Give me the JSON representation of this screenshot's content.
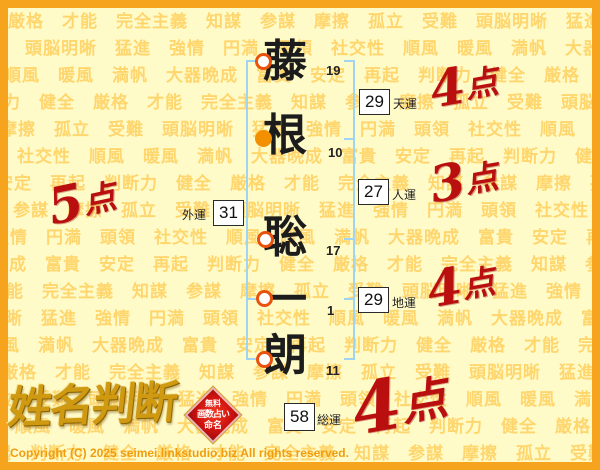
{
  "page": {
    "bg_color": "#fffbc9",
    "border_color": "#f6a41e",
    "bracket_color": "#9fd4f2",
    "score_color": "#ba0f0f"
  },
  "watermark": {
    "words": [
      "厳格",
      "才能",
      "完全主義",
      "知謀",
      "参謀",
      "摩擦",
      "孤立",
      "受難",
      "頭脳明晰",
      "猛進",
      "強情",
      "円満",
      "頭領",
      "社交性",
      "順風",
      "暖風",
      "満帆",
      "大器晩成",
      "富貴",
      "安定",
      "再起",
      "判断力",
      "健全"
    ],
    "color": "#ffd66e"
  },
  "name": {
    "characters": [
      {
        "char": "藤",
        "strokes": "19",
        "marker": "ring"
      },
      {
        "char": "根",
        "strokes": "10",
        "marker": "filled"
      },
      {
        "char": "聡",
        "strokes": "17",
        "marker": "ring"
      },
      {
        "char": "一",
        "strokes": "1",
        "marker": "ring"
      },
      {
        "char": "朗",
        "strokes": "11",
        "marker": "ring"
      }
    ]
  },
  "fortunes": {
    "tenun": {
      "label": "天運",
      "value": "29",
      "score": "4",
      "suffix": "点"
    },
    "jinun": {
      "label": "人運",
      "value": "27",
      "score": "3",
      "suffix": "点"
    },
    "chiun": {
      "label": "地運",
      "value": "29",
      "score": "4",
      "suffix": "点"
    },
    "gaiun": {
      "label": "外運",
      "value": "31",
      "score": "5",
      "suffix": "点"
    },
    "soun": {
      "label": "総運",
      "value": "58",
      "score": "4",
      "suffix": "点"
    }
  },
  "logo": {
    "title": "姓名判断",
    "seal_lines": [
      "無料",
      "画数占い",
      "命名"
    ]
  },
  "footer": {
    "copyright": "Copyright (C) 2025 seimei.linkstudio.biz All rights reserved."
  }
}
